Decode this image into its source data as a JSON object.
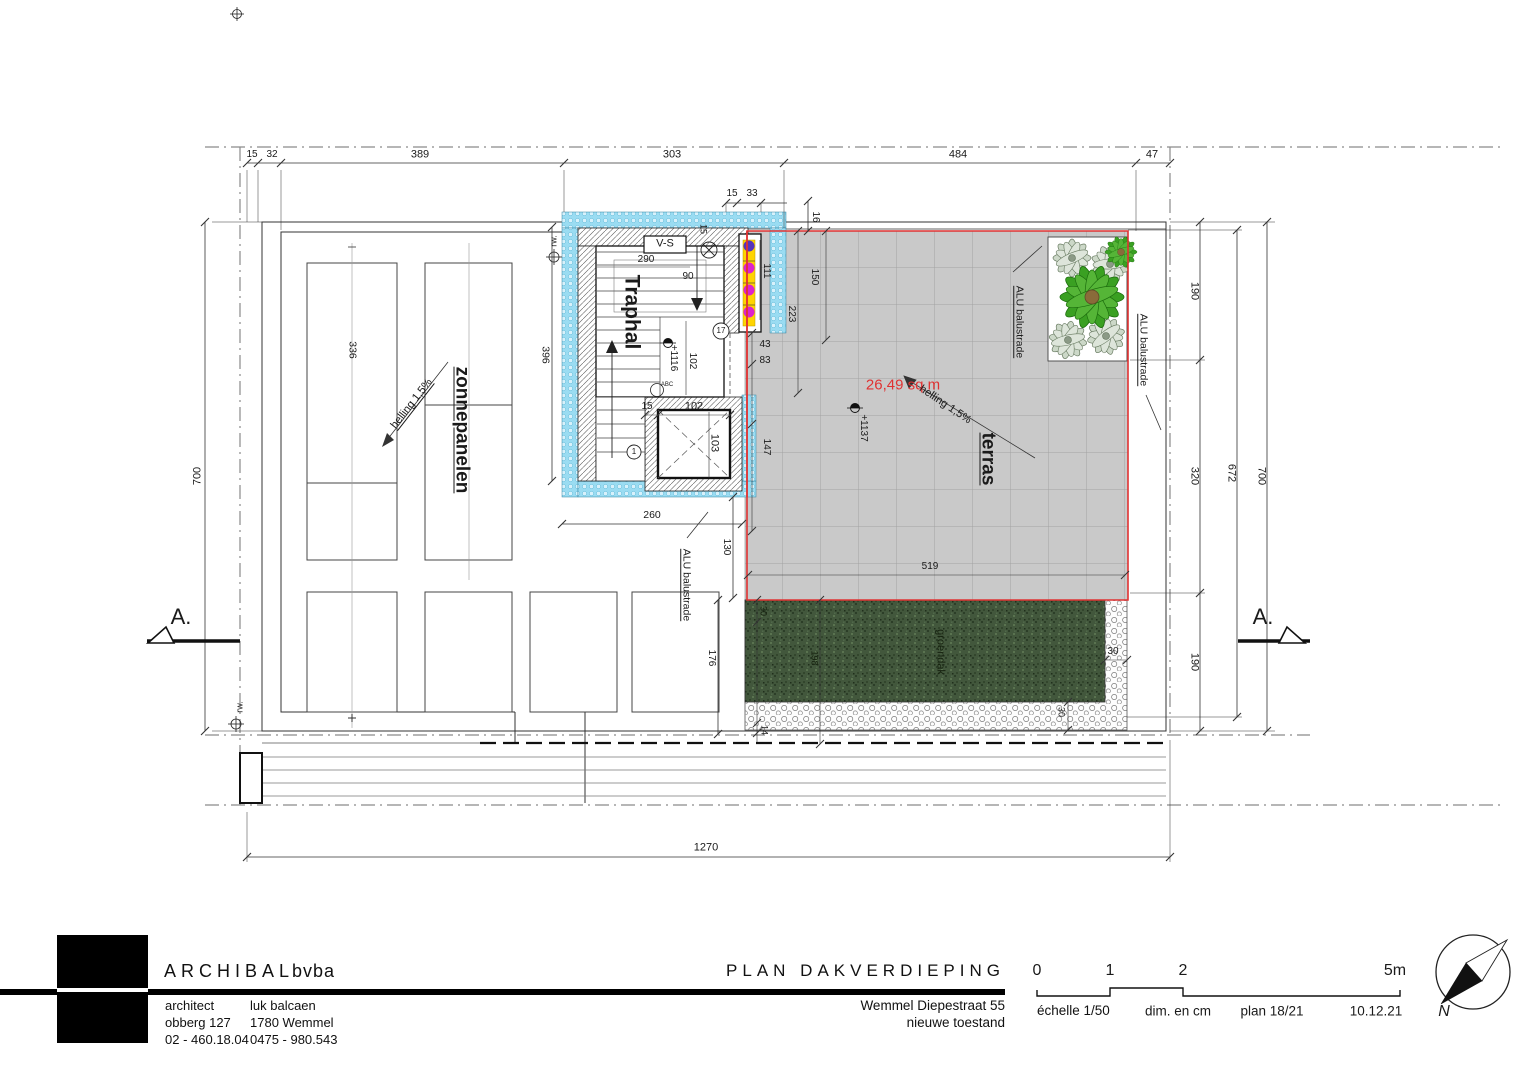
{
  "colors": {
    "balustrade_red": "#e03232",
    "insulation_blue": "#9adcf2",
    "terrace_gray": "#c9c9c9",
    "green_roof": "#42573c",
    "glass_yellow": "#ffd400",
    "glass_magenta": "#dd22cc"
  },
  "plan": {
    "rooms": {
      "traphal": "Traphal",
      "vs_label": "V-S",
      "terras": "terras",
      "zonnepanelen": "zonnepanelen",
      "groendak": "groendak"
    },
    "annotations": {
      "area": "26,49 sq m",
      "slope_left": "helling 1,5%",
      "slope_terrace": "helling 1,5%",
      "balustrade_1": "ALU balustrade",
      "balustrade_2": "ALU balustrade",
      "balustrade_3": "ALU balustrade",
      "level_stair": "+1116",
      "level_terrace": "+1137",
      "rw_top": "rw.",
      "rw_bottom": "rw.",
      "section_left": "A.",
      "section_right": "A.",
      "abc": "ABC",
      "c1": "1",
      "c17": "17"
    },
    "dims": {
      "top": [
        "15",
        "32",
        "389",
        "303",
        "484",
        "47"
      ],
      "top2": [
        "15",
        "33"
      ],
      "d16": "16",
      "left_700": "700",
      "right_190a": "190",
      "right_320": "320",
      "right_190b": "190",
      "right_672": "672",
      "right_700": "700",
      "bottom_1270": "1270",
      "v396": "396",
      "v336": "336",
      "h260": "260",
      "h290": "290",
      "h90": "90",
      "v111": "111",
      "v102": "102",
      "v15w": "15",
      "lift_15": "15",
      "lift_102": "102",
      "lift_103": "103",
      "h43": "43",
      "h83": "83",
      "v147": "147",
      "v150": "150",
      "v223": "223",
      "h519": "519",
      "v130": "130",
      "v176": "176",
      "v14": "14",
      "v30a": "30",
      "v198": "198",
      "h30b": "30",
      "v30c": "30"
    }
  },
  "title_block": {
    "company_name": "ARCHIBAL",
    "company_suffix": "bvba",
    "contact": {
      "row1_left": "architect",
      "row1_right": "luk balcaen",
      "row2_left": "obberg 127",
      "row2_right": "1780 Wemmel",
      "row3_left": "02 - 460.18.04",
      "row3_right": "0475 - 980.543"
    },
    "plan_title": "PLAN DAKVERDIEPING",
    "project_address": "Wemmel Diepestraat 55",
    "project_state": "nieuwe toestand",
    "scalebar": {
      "t0": "0",
      "t1": "1",
      "t2": "2",
      "t5": "5m",
      "scale": "échelle 1/50",
      "units": "dim. en cm",
      "plan_no": "plan 18/21",
      "date": "10.12.21"
    },
    "north": "N"
  }
}
